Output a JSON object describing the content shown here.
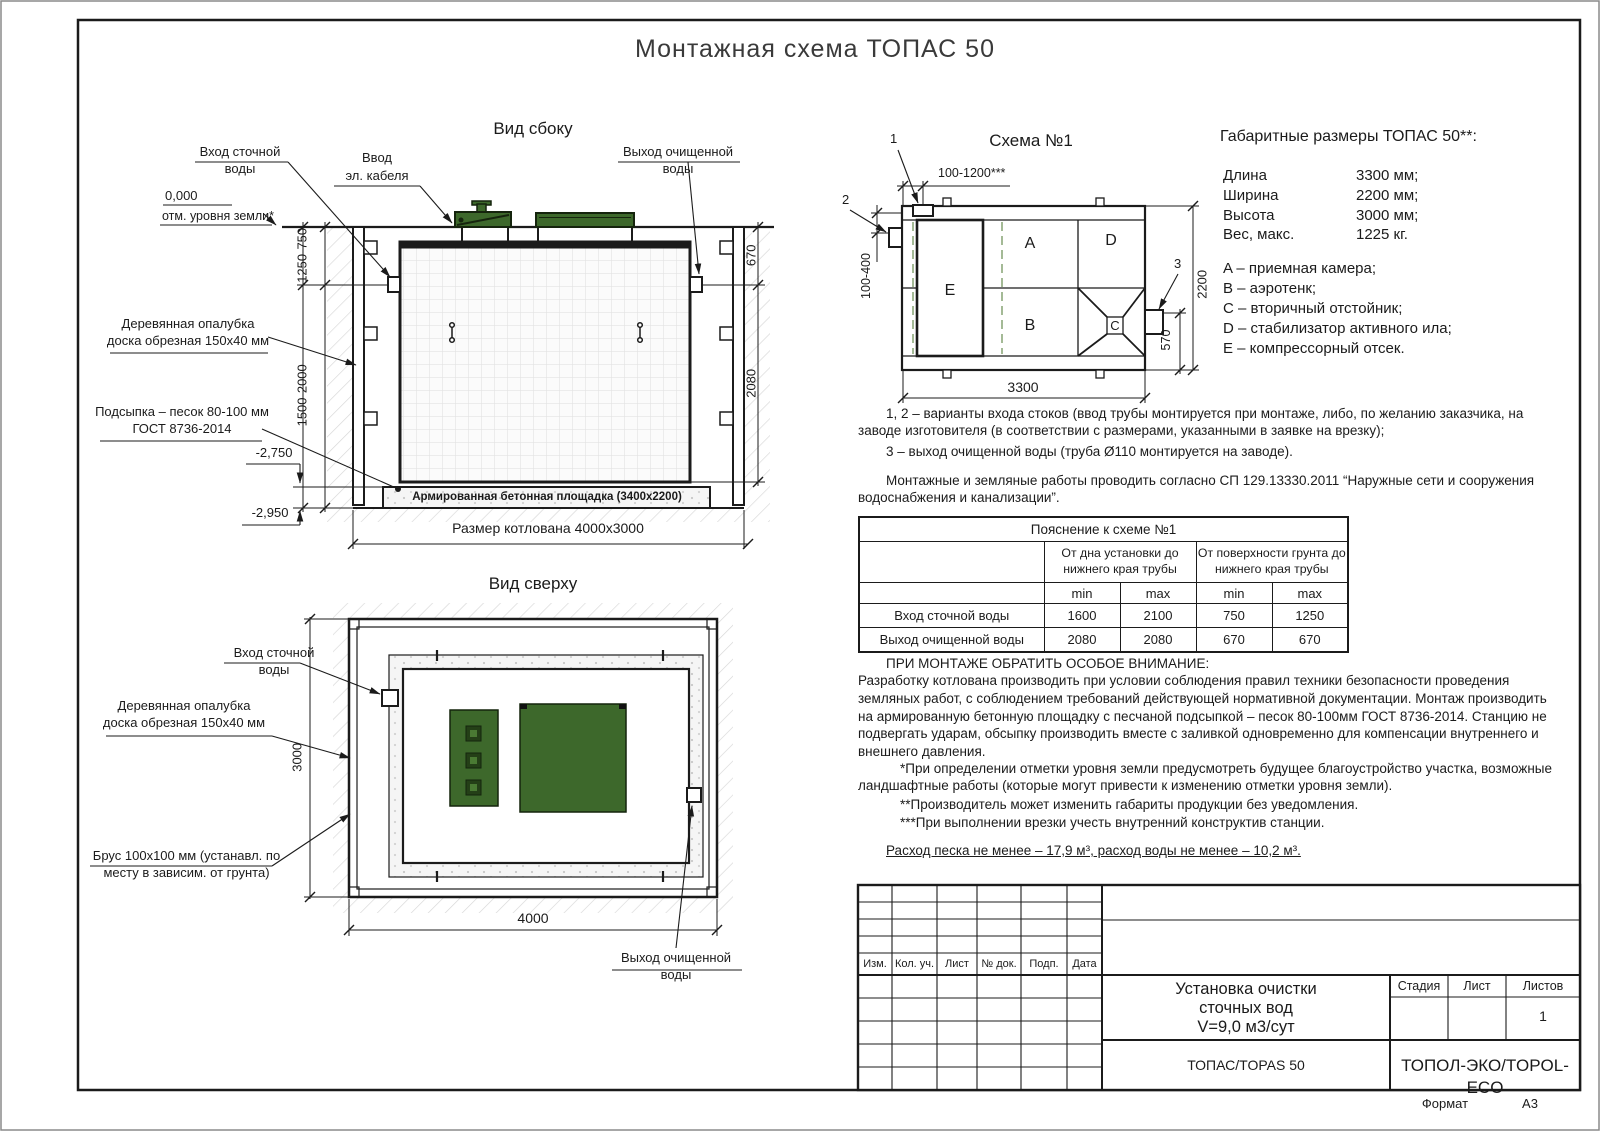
{
  "title": "Монтажная схема ТОПАС 50",
  "side_view": {
    "title": "Вид сбоку",
    "inlet_label": "Вход сточной воды",
    "cable_label_1": "Ввод",
    "cable_label_2": "эл. кабеля",
    "outlet_label": "Выход очищенной воды",
    "zero_mark": "0,000",
    "ground_label": "отм. уровня земли*",
    "formwork_label": "Деревянная опалубка доска обрезная 150х40 мм",
    "sand_label": "Подсыпка – песок 80-100 мм ГОСТ 8736-2014",
    "elev_pad": "-2,750",
    "elev_bottom": "-2,950",
    "dim_upper_left": "1250-750",
    "dim_lower_left": "1500-2000",
    "dim_upper_right": "670",
    "dim_lower_right": "2080",
    "pad_label": "Армированная бетонная площадка (3400х2200)",
    "pit_dim": "Размер котлована 4000х3000"
  },
  "top_view": {
    "title": "Вид сверху",
    "inlet_label": "Вход сточной воды",
    "formwork_label": "Деревянная опалубка доска обрезная 150х40 мм",
    "timber_label": "Брус 100х100 мм (устанавл. по месту в зависим. от грунта)",
    "outlet_label": "Выход очищенной воды",
    "dim_width": "3000",
    "dim_length": "4000"
  },
  "schema": {
    "title": "Схема №1",
    "marker_1": "1",
    "marker_2": "2",
    "marker_3": "3",
    "dim_top": "100-1200***",
    "dim_inlet": "100-400",
    "dim_height": "2200",
    "dim_outlet": "570",
    "dim_length": "3300",
    "comp_a": "A",
    "comp_b": "B",
    "comp_c": "C",
    "comp_d": "D",
    "comp_e": "E"
  },
  "overall": {
    "title": "Габаритные размеры ТОПАС 50**:",
    "rows": [
      {
        "label": "Длина",
        "value": "3300 мм;"
      },
      {
        "label": "Ширина",
        "value": "2200 мм;"
      },
      {
        "label": "Высота",
        "value": "3000 мм;"
      },
      {
        "label": "Вес, макс.",
        "value": "1225 кг."
      }
    ],
    "legend": [
      "A – приемная камера;",
      "B – аэротенк;",
      "C – вторичный отстойник;",
      "D – стабилизатор активного ила;",
      "E – компрессорный отсек."
    ]
  },
  "notes": {
    "variants_1": "1, 2 – варианты входа стоков (ввод трубы монтируется при монтаже, либо, по желанию заказчика, на заводе изготовителя (в соответствии с размерами, указанными в заявке на врезку);",
    "variants_2": "3 – выход очищенной воды (труба Ø110 монтируется на заводе).",
    "sp": "Монтажные и земляные работы проводить согласно СП 129.13330.2011 “Наружные сети и сооружения водоснабжения и канализации”.",
    "attention_title": "ПРИ МОНТАЖЕ ОБРАТИТЬ ОСОБОЕ ВНИМАНИЕ:",
    "attention_body": "Разработку котлована производить при условии соблюдения правил техники безопасности проведения земляных работ, с соблюдением требований действующей нормативной документации.  Монтаж производить на армированную бетонную площадку с песчаной подсыпкой – песок 80-100мм ГОСТ 8736-2014. Станцию не подвергать ударам, обсыпку производить вместе с заливкой одновременно для компенсации внутреннего и внешнего давления.",
    "footnote_1": "*При определении отметки уровня земли предусмотреть будущее благоустройство участка, возможные ландшафтные работы (которые могут привести к изменению отметки уровня земли).",
    "footnote_2": "**Производитель может изменить габариты продукции без уведомления.",
    "footnote_3": "***При выполнении врезки учесть внутренний конструктив станции.",
    "consumption": "Расход песка не менее – 17,9 м³, расход воды не менее – 10,2 м³."
  },
  "table": {
    "title": "Пояснение к схеме №1",
    "group_1": "От дна установки до нижнего края трубы",
    "group_2": "От поверхности грунта до нижнего края трубы",
    "min_label": "min",
    "max_label": "max",
    "rows": [
      {
        "label": "Вход сточной воды",
        "v1": "1600",
        "v2": "2100",
        "v3": "750",
        "v4": "1250"
      },
      {
        "label": "Выход очищенной воды",
        "v1": "2080",
        "v2": "2080",
        "v3": "670",
        "v4": "670"
      }
    ]
  },
  "title_block": {
    "rev_headers": [
      "Изм.",
      "Кол. уч.",
      "Лист",
      "№ док.",
      "Подп.",
      "Дата"
    ],
    "doc_title_1": "Установка очистки",
    "doc_title_2": "сточных вод",
    "doc_title_3": "V=9,0 м3/сут",
    "stage_label": "Стадия",
    "sheet_label": "Лист",
    "sheets_label": "Листов",
    "sheets_value": "1",
    "product": "ТОПАС/TOPAS 50",
    "company": "ТОПОЛ-ЭКО/TOPOL-ECO",
    "format_label": "Формат",
    "format_value": "А3"
  },
  "colors": {
    "cover_green": "#3d682b",
    "cover_green_dark": "#15240d",
    "dash_green": "#85a374",
    "line": "#1b1b1b"
  }
}
